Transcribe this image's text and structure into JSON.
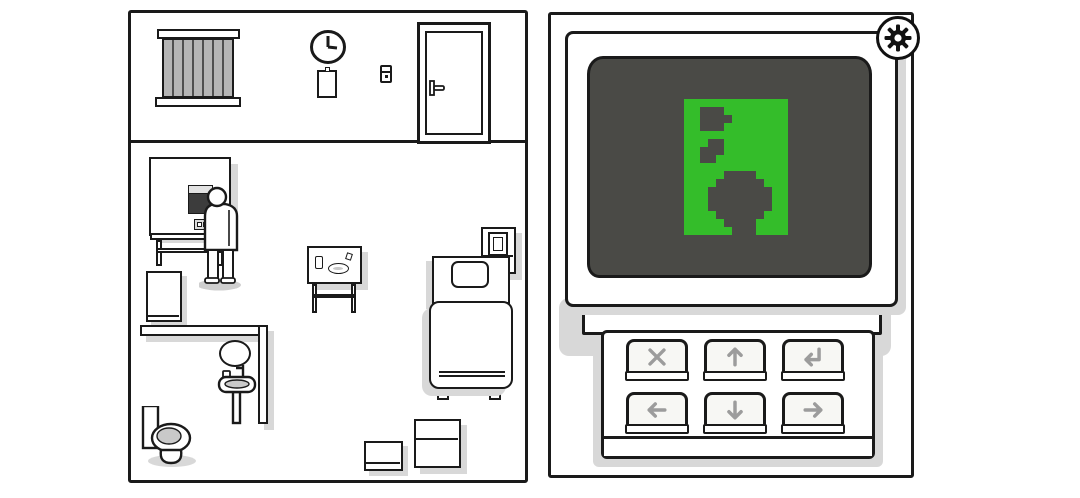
{
  "scene": {
    "left_room": {
      "name": "patient-room",
      "wall_clock_time": "3:00",
      "objects": [
        "window-blinds",
        "wall-clock",
        "notepad",
        "light-switch",
        "door",
        "food-machine",
        "machine-screen",
        "man-standing",
        "desk",
        "fridge",
        "partition-counter",
        "mirror",
        "sink",
        "toilet",
        "side-table",
        "cup",
        "plate",
        "bed",
        "pillow",
        "nightstand",
        "picture-frame",
        "large-box",
        "small-box"
      ]
    },
    "right_device": {
      "name": "monitor-with-keypad",
      "settings_button": {
        "icon": "gear-icon"
      },
      "screen": {
        "background": "#4a4a46",
        "plate_color": "#34bd2a",
        "pixel_color": "#4a4a46",
        "pixel_size": 8,
        "grid_cols": 13,
        "grid_rows": 17,
        "pixel_rows": [
          ".............",
          "..###........",
          "..####.......",
          "..###........",
          ".............",
          "...##........",
          "..###........",
          "..##.........",
          ".............",
          ".....####....",
          "....######...",
          "...########..",
          "...########..",
          "...########..",
          "....######...",
          ".....####....",
          "......###...."
        ]
      },
      "keypad_keys": [
        {
          "name": "cancel",
          "icon": "cross-icon"
        },
        {
          "name": "up",
          "icon": "arrow-up-icon"
        },
        {
          "name": "enter",
          "icon": "enter-icon"
        },
        {
          "name": "left",
          "icon": "arrow-left-icon"
        },
        {
          "name": "down",
          "icon": "arrow-down-icon"
        },
        {
          "name": "right",
          "icon": "arrow-right-icon"
        }
      ]
    }
  },
  "colors": {
    "outline": "#1a1a1a",
    "shadow": "#d8d8d8",
    "blinds": "#b5b5b5",
    "blind_slats": "#4f4f4f",
    "key_icon": "#9c9c9c",
    "screen_dark": "#4a4a46",
    "screen_green": "#34bd2a",
    "seat_gray": "#c9c9c9"
  }
}
